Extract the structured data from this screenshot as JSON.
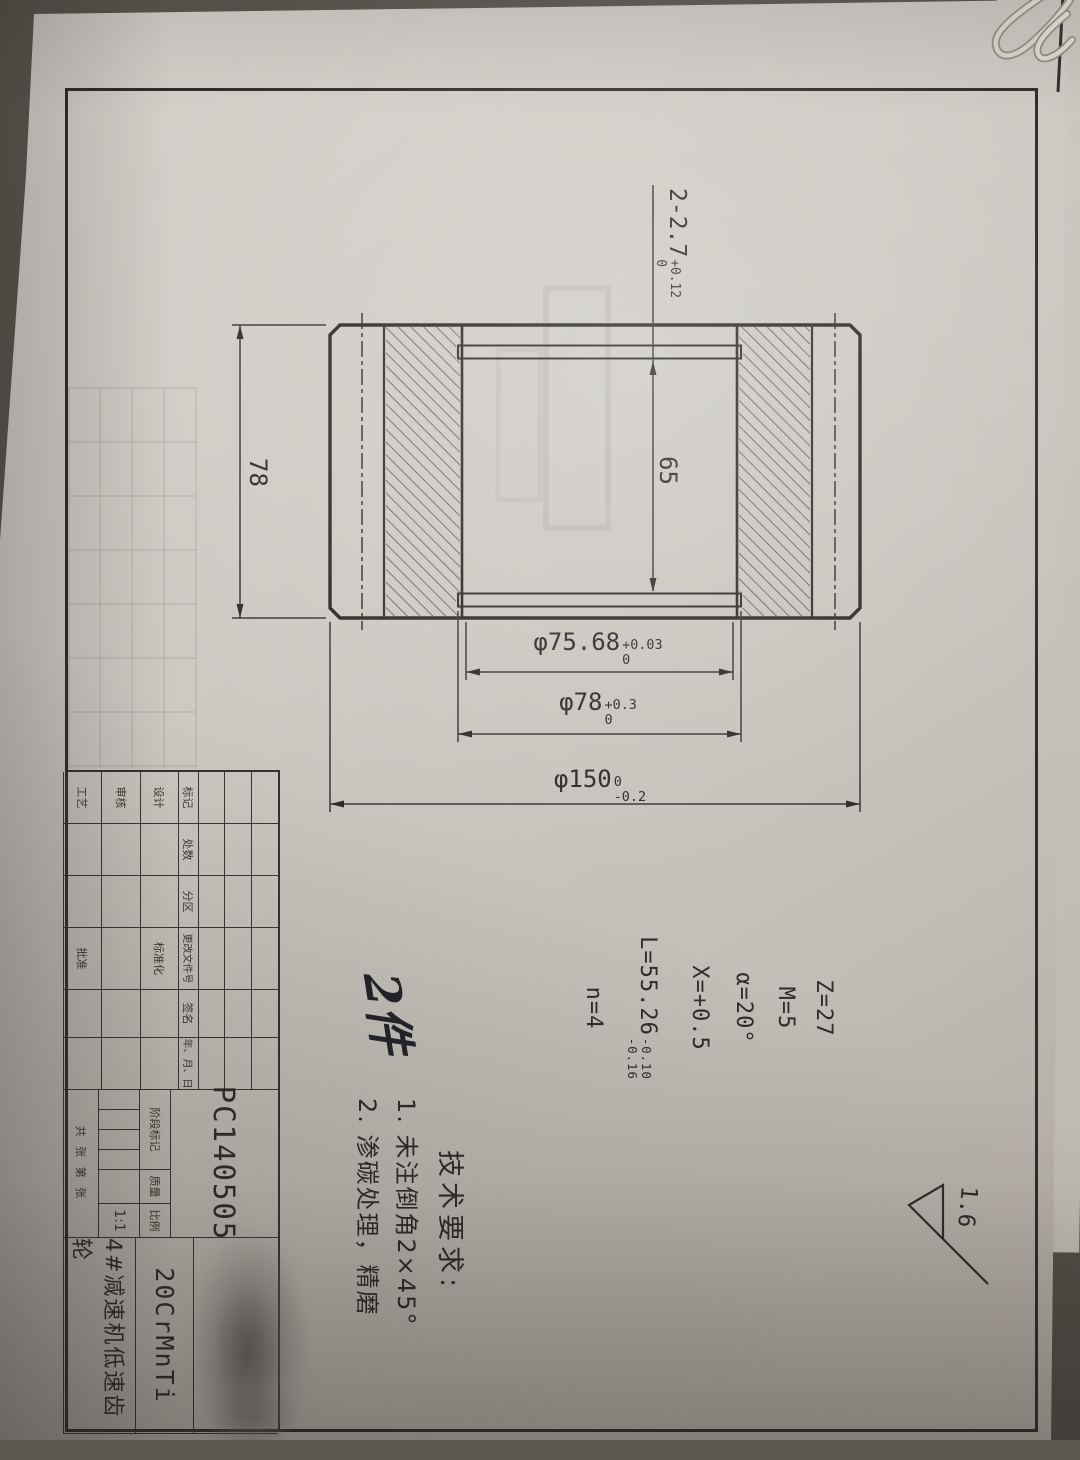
{
  "sheet": {
    "drawing_no": "PC140505",
    "material": "20CrMnTi",
    "part_name": "4#减速机低速齿轮",
    "scale_value": "1:1",
    "quantity_note": "2件",
    "surface_finish": "1.6"
  },
  "dims": {
    "width": "78",
    "groove_span": "65",
    "groove_note": {
      "main": "2-2.7",
      "upper": "+0.12",
      "lower": "0"
    },
    "bore_dia": {
      "main": "φ75.68",
      "upper": "+0.03",
      "lower": "0"
    },
    "groove_dia": {
      "main": "φ78",
      "upper": "+0.3",
      "lower": "0"
    },
    "outer_dia": {
      "main": "φ150",
      "upper": "0",
      "lower": "-0.2"
    }
  },
  "gear_params": {
    "teeth": "Z=27",
    "module": "M=5",
    "pressure_angle": "α=20°",
    "shift": "X=+0.5",
    "span_length": {
      "main": "L=55.26",
      "upper": "-0.10",
      "lower": "-0.16"
    },
    "span_teeth": "n=4"
  },
  "tech_req": {
    "title": "技术要求:",
    "item1": "1. 未注倒角2×45°",
    "item2": "2. 渗碳处理，精磨"
  },
  "title_block": {
    "rev_headers": {
      "mark": "标记",
      "count": "处数",
      "zone": "分区",
      "doc_no": "更改文件号",
      "sign": "签名",
      "date": "年、月、日"
    },
    "roles": {
      "design": "设计",
      "standard": "标准化",
      "check": "审核",
      "process": "工艺",
      "approve": "批准"
    },
    "labels": {
      "stage": "阶段标记",
      "weight": "质量",
      "scale": "比例",
      "sheets": "共 张  第 张"
    }
  }
}
